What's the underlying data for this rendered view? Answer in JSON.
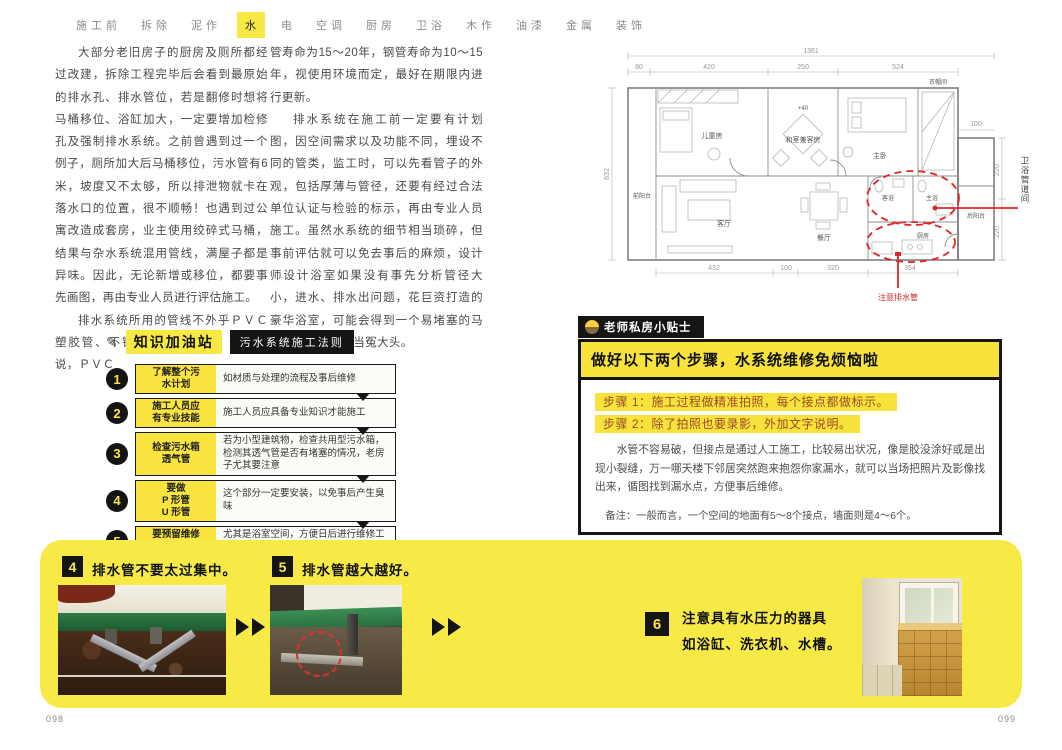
{
  "nav": {
    "items": [
      "施工前",
      "拆除",
      "泥作",
      "水",
      "电",
      "空调",
      "厨房",
      "卫浴",
      "木作",
      "油漆",
      "金属",
      "装饰"
    ],
    "active_index": 3
  },
  "article": {
    "col1_p1": "大部分老旧房子的厨房及厕所都经过改建，拆除工程完毕后会看到最原始的排水孔、排水管位，若是翻修时想将马桶移位、浴缸加大，一定要增加检修孔及强制排水系统。之前曾遇到过一个例子，厕所加大后马桶移位，污水管有6米，坡度又不太够，所以排泄物就卡在落水口的位置，很不顺畅！也遇到过公寓改造成套房，业主使用绞碎式马桶，结果与杂水系统混用管线，满屋子都是异味。因此，无论新增或移位，都要事先画图，再由专业人员进行评估施工。",
    "col1_p2": "排水系统所用的管线不外乎ＰＶＣ塑胶管、不锈钢管以及钢管，一般来说，ＰＶＣ",
    "col2_p1": "管寿命为15～20年，钢管寿命为10～15年，视使用环境而定，最好在期限内进行更新。",
    "col2_p2": "排水系统在施工前一定要有计划图，因空间需求以及功能不同，埋设不同的管类，监工时，可以先看管子的外观，包括厚薄与管径，还要有经过合法单位认证与检验的标示，再由专业人员施工。虽然水系统的细节相当琐碎，但事前评估就可以免去事后的麻烦，设计师设计浴室如果没有事先分析管径大小，进水、排水出问题，花巨资打造的豪华浴室，可能会得到一个易堵塞的马桶，相信没人想当冤大头。"
  },
  "knowledge": {
    "icon": "✎",
    "title": "知识加油站",
    "tag": "污水系统施工法则",
    "steps": [
      {
        "num": "1",
        "label": "了解整个污\n水计划",
        "desc": "如材质与处理的流程及事后维修"
      },
      {
        "num": "2",
        "label": "施工人员应\n有专业技能",
        "desc": "施工人员应具备专业知识才能施工"
      },
      {
        "num": "3",
        "label": "检查污水箱\n透气管",
        "desc": "若为小型建筑物，检查共用型污水箱，检测其透气管是否有堵塞的情况，老房子尤其要注意"
      },
      {
        "num": "4",
        "label": "要做\nP 形管\nU 形管",
        "desc": "这个部分一定要安装，以免事后产生臭味"
      },
      {
        "num": "5",
        "label": "要预留维修\n孔位置",
        "desc": "尤其是浴室空间，方便日后进行维修工作"
      }
    ]
  },
  "floorplan": {
    "rooms": {
      "front_balcony": "前阳台",
      "children_room": "儿童房",
      "tatami_room": "和室兼客房",
      "tatami_note": "+40",
      "master_bedroom": "主卧",
      "closet": "衣帽间",
      "living_room": "客厅",
      "dining_room": "餐厅",
      "guest_bath": "客浴",
      "master_bath": "主浴",
      "kitchen": "厨房",
      "back_balcony": "后阳台"
    },
    "dims": {
      "total_width": "1361",
      "top": [
        "80",
        "420",
        "250",
        "524"
      ],
      "left": "832",
      "right_top": "100",
      "right": [
        "220",
        "220"
      ],
      "bottom": [
        "432",
        "100",
        "320",
        "354"
      ]
    },
    "annotations": {
      "pipe_duct": "卫浴管道间",
      "drain_note": "注意排水管"
    }
  },
  "tips": {
    "tab": "老师私房小贴士",
    "title": "做好以下两个步骤，水系统维修免烦恼啦",
    "step1": "步骤 1：施工过程做精准拍照，每个接点都做标示。",
    "step2": "步骤 2：除了拍照也要录影，外加文字说明。",
    "body": "水管不容易破，但接点是通过人工施工，比较易出状况，像是胶没涂好或是出现小裂缝，万一哪天楼下邻居突然跑来抱怨你家漏水，就可以当场把照片及影像找出来，循图找到漏水点，方便事后维修。",
    "note": "备注：一般而言，一个空间的地面有5～8个接点，墙面则是4～6个。"
  },
  "gallery": {
    "item4": {
      "num": "4",
      "caption": "排水管不要太过集中。"
    },
    "item5": {
      "num": "5",
      "caption": "排水管越大越好。"
    },
    "item6": {
      "num": "6",
      "caption_line1": "注意具有水压力的器具",
      "caption_line2": "如浴缸、洗衣机、水槽。"
    }
  },
  "pages": {
    "left": "098",
    "right": "099"
  }
}
